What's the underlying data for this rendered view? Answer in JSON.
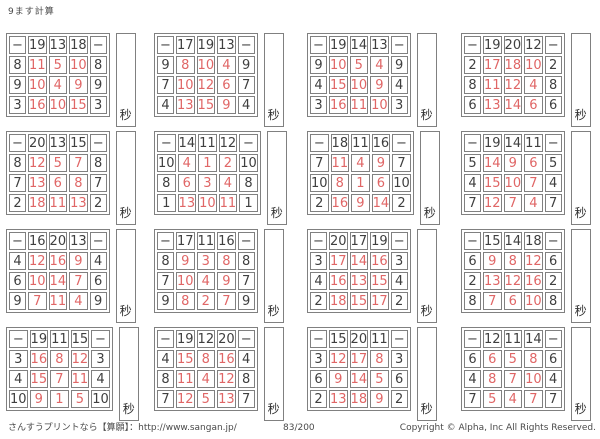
{
  "title": "9ます計算",
  "operator": "−",
  "seconds_label": "秒",
  "colors": {
    "answer_red": "#e06666",
    "ink": "#3f3f3f",
    "border_gray": "#808080"
  },
  "footer": {
    "left": "さんすうプリントなら【算願】：http://www.sangan.jp/",
    "center": "83/200",
    "right": "Copyright © Alpha, Inc All Rights Reserved."
  },
  "blocks": [
    {
      "top": [
        19,
        13,
        18
      ],
      "left": [
        8,
        9,
        3
      ],
      "answers": [
        [
          11,
          5,
          10
        ],
        [
          10,
          4,
          9
        ],
        [
          16,
          10,
          15
        ]
      ]
    },
    {
      "top": [
        17,
        19,
        13
      ],
      "left": [
        9,
        7,
        4
      ],
      "answers": [
        [
          8,
          10,
          4
        ],
        [
          10,
          12,
          6
        ],
        [
          13,
          15,
          9
        ]
      ]
    },
    {
      "top": [
        19,
        14,
        13
      ],
      "left": [
        9,
        4,
        3
      ],
      "answers": [
        [
          10,
          5,
          4
        ],
        [
          15,
          10,
          9
        ],
        [
          16,
          11,
          10
        ]
      ]
    },
    {
      "top": [
        19,
        20,
        12
      ],
      "left": [
        2,
        8,
        6
      ],
      "answers": [
        [
          17,
          18,
          10
        ],
        [
          11,
          12,
          4
        ],
        [
          13,
          14,
          6
        ]
      ]
    },
    {
      "top": [
        20,
        13,
        15
      ],
      "left": [
        8,
        7,
        2
      ],
      "answers": [
        [
          12,
          5,
          7
        ],
        [
          13,
          6,
          8
        ],
        [
          18,
          11,
          13
        ]
      ]
    },
    {
      "top": [
        14,
        11,
        12
      ],
      "left": [
        10,
        8,
        1
      ],
      "answers": [
        [
          4,
          1,
          2
        ],
        [
          6,
          3,
          4
        ],
        [
          13,
          10,
          11
        ]
      ]
    },
    {
      "top": [
        18,
        11,
        16
      ],
      "left": [
        7,
        10,
        2
      ],
      "answers": [
        [
          11,
          4,
          9
        ],
        [
          8,
          1,
          6
        ],
        [
          16,
          9,
          14
        ]
      ]
    },
    {
      "top": [
        19,
        14,
        11
      ],
      "left": [
        5,
        4,
        7
      ],
      "answers": [
        [
          14,
          9,
          6
        ],
        [
          15,
          10,
          7
        ],
        [
          12,
          7,
          4
        ]
      ]
    },
    {
      "top": [
        16,
        20,
        13
      ],
      "left": [
        4,
        6,
        9
      ],
      "answers": [
        [
          12,
          16,
          9
        ],
        [
          10,
          14,
          7
        ],
        [
          7,
          11,
          4
        ]
      ]
    },
    {
      "top": [
        17,
        11,
        16
      ],
      "left": [
        8,
        7,
        9
      ],
      "answers": [
        [
          9,
          3,
          8
        ],
        [
          10,
          4,
          9
        ],
        [
          8,
          2,
          7
        ]
      ]
    },
    {
      "top": [
        20,
        17,
        19
      ],
      "left": [
        3,
        4,
        2
      ],
      "answers": [
        [
          17,
          14,
          16
        ],
        [
          16,
          13,
          15
        ],
        [
          18,
          15,
          17
        ]
      ]
    },
    {
      "top": [
        15,
        14,
        18
      ],
      "left": [
        6,
        2,
        8
      ],
      "answers": [
        [
          9,
          8,
          12
        ],
        [
          13,
          12,
          16
        ],
        [
          7,
          6,
          10
        ]
      ]
    },
    {
      "top": [
        19,
        11,
        15
      ],
      "left": [
        3,
        4,
        10
      ],
      "answers": [
        [
          16,
          8,
          12
        ],
        [
          15,
          7,
          11
        ],
        [
          9,
          1,
          5
        ]
      ]
    },
    {
      "top": [
        19,
        12,
        20
      ],
      "left": [
        4,
        8,
        7
      ],
      "answers": [
        [
          15,
          8,
          16
        ],
        [
          11,
          4,
          12
        ],
        [
          12,
          5,
          13
        ]
      ]
    },
    {
      "top": [
        15,
        20,
        11
      ],
      "left": [
        3,
        6,
        2
      ],
      "answers": [
        [
          12,
          17,
          8
        ],
        [
          9,
          14,
          5
        ],
        [
          13,
          18,
          9
        ]
      ]
    },
    {
      "top": [
        12,
        11,
        14
      ],
      "left": [
        6,
        4,
        7
      ],
      "answers": [
        [
          6,
          5,
          8
        ],
        [
          8,
          7,
          10
        ],
        [
          5,
          4,
          7
        ]
      ]
    }
  ]
}
